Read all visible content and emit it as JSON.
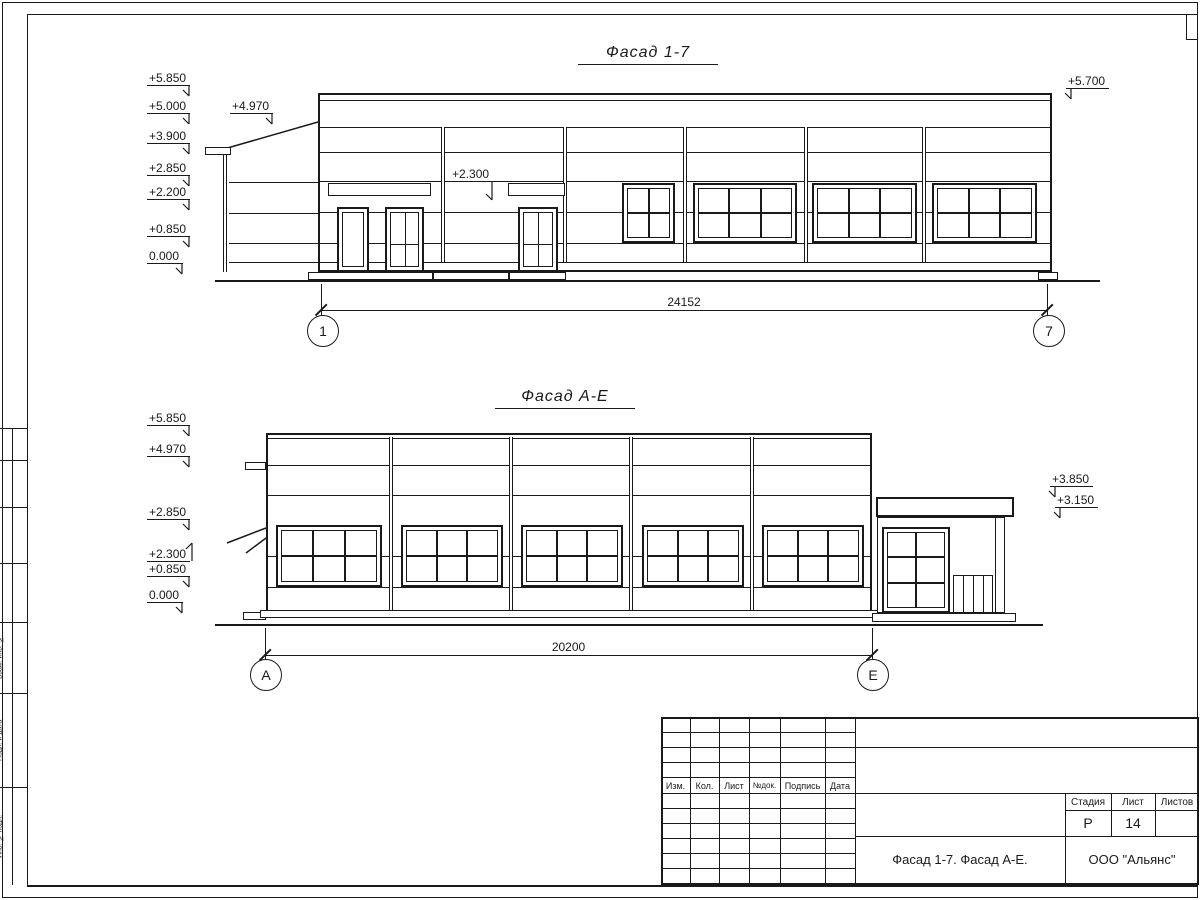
{
  "facade1": {
    "title": "Фасад 1-7",
    "dimension": "24152",
    "axis_left": "1",
    "axis_right": "7",
    "elevations_left": [
      "+5.850",
      "+5.000",
      "+3.900",
      "+2.850",
      "+2.200",
      "+0.850",
      "0.000"
    ],
    "elevation_porch": "+4.970",
    "elevation_canopy": "+2.300",
    "elevation_right": "+5.700"
  },
  "facade2": {
    "title": "Фасад А-Е",
    "dimension": "20200",
    "axis_left": "А",
    "axis_right": "Е",
    "elevations_left": [
      "+5.850",
      "+4.970",
      "+2.850",
      "+2.300",
      "+0.850",
      "0.000"
    ],
    "elevations_right": [
      "+3.850",
      "+3.150"
    ]
  },
  "title_block": {
    "columns": [
      "Изм.",
      "Кол.",
      "Лист",
      "№док.",
      "Подпись",
      "Дата"
    ],
    "stage_label": "Стадия",
    "sheet_label": "Лист",
    "sheets_label": "Листов",
    "stage_value": "Р",
    "sheet_value": "14",
    "sheets_value": "",
    "drawing_name": "Фасад 1-7. Фасад А-Е.",
    "company": "ООО \"Альянс\""
  },
  "frame": {
    "side_labels": [
      "Взам. инв. №",
      "Подп. и дата",
      "Инв. № подл."
    ]
  }
}
